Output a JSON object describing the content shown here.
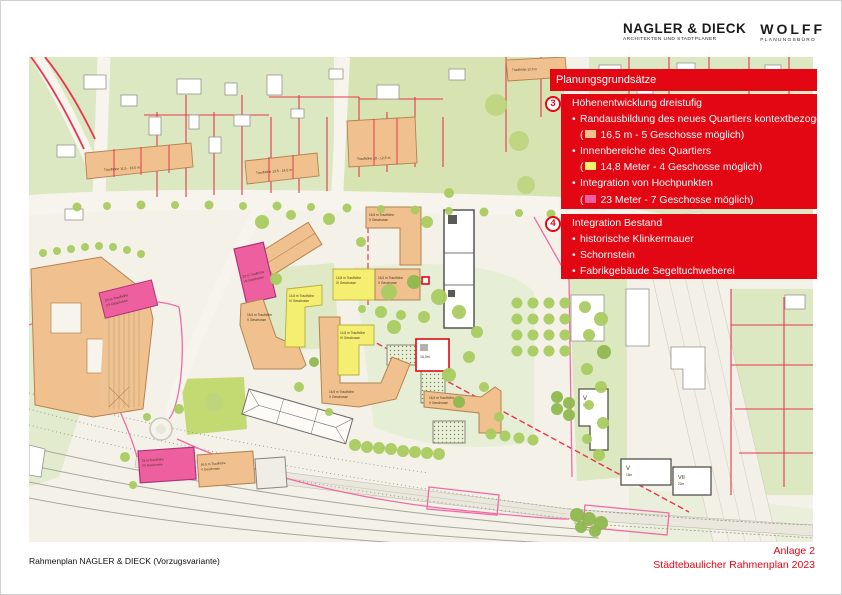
{
  "header": {
    "firm1_name": "NAGLER & DIECK",
    "firm1_sub": "ARCHITEKTEN UND STADTPLANER",
    "firm2_name": "WOLFF",
    "firm2_sub": "PLANUNGSBÜRO"
  },
  "legend": {
    "title": "Planungsgrundsätze",
    "bullet_char": "•",
    "paren_open": "(",
    "box3": {
      "number": "3",
      "heading": "Höhenentwicklung dreistufig",
      "bullet1": "Randausbildung des neues Quartiers kontextbezogen",
      "paren1_text": "16,5 m - 5 Geschosse möglich)",
      "bullet2": "Innenbereiche des Quartiers",
      "paren2_text": "14,8 Meter - 4 Geschosse möglich)",
      "bullet3": "Integration von Hochpunkten",
      "paren3_text": "23 Meter - 7 Geschosse möglich)",
      "swatch_orange": "#f0c18e",
      "swatch_yellow": "#f4ee71",
      "swatch_pink": "#ee5fa0"
    },
    "box4": {
      "number": "4",
      "heading": "Integration Bestand",
      "bullet1": "historische Klinkermauer",
      "bullet2": "Schornstein",
      "bullet3": "Fabrikgebäude Segeltuchweberei"
    }
  },
  "footer": {
    "left": "Rahmenplan NAGLER & DIECK (Vorzugsvariante)",
    "right_line1": "Anlage 2",
    "right_line2": "Städtebaulicher Rahmenplan 2023"
  },
  "map": {
    "labels": {
      "row1": "Traufhöhe 11,5 - 13,5 m",
      "row2": "Traufhöhe 13,5 - 14,5 m",
      "row3": "Traufhöhe 10 - 12,5 m",
      "row4": "Traufhöhe 12,5 m",
      "orange_h1": "16,5 m Traufhöhe",
      "orange_h2": "V Geschosse",
      "yellow_h1": "14,8 m Traufhöhe",
      "yellow_h2": "IV Geschosse",
      "pink_h1": "23 m Traufhöhe",
      "pink_h2": "VII Geschosse",
      "tower1_floors": "V",
      "tower1_height": "16m",
      "tower2_floors": "V",
      "tower2_height": "16m",
      "tower3_floors": "VII",
      "tower3_height": "22m",
      "special_height": "16,5m"
    },
    "colors": {
      "accent_red": "#e30613",
      "building_orange": "#f0c18e",
      "building_yellow": "#f4ee71",
      "building_pink": "#ee5fa0",
      "parcel_green": "#dce8c2",
      "lawn_green": "#c3da72",
      "tree_green": "#a9cb60",
      "boundary_red": "#e8364f",
      "boundary_pink": "#f26ba5"
    }
  }
}
